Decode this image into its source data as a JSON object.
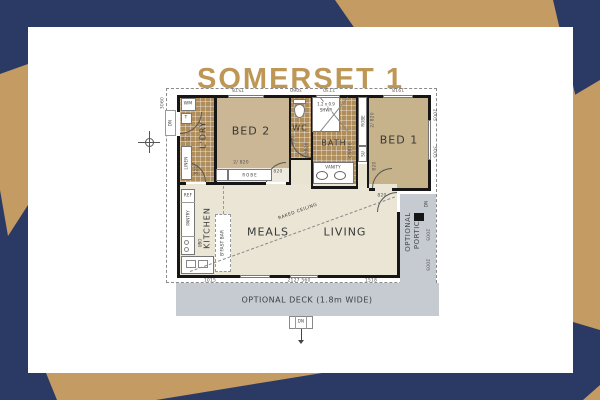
{
  "title": "SOMERSET 1",
  "colors": {
    "background_navy": "#2B3A64",
    "accent_gold": "#C39B63",
    "title_gold": "#BE9757",
    "wet_area_tile_tan": "#B08E5C",
    "bedroom_tan": "#CBB795",
    "floor_cream": "#EAE5D4",
    "deck_gray": "#C6CAD1"
  },
  "plan": {
    "rooms": {
      "ldry": "L'DRY",
      "bed2": "BED 2",
      "wc": "WC",
      "bath": "BATH",
      "bed1": "BED 1",
      "kitchen": "KITCHEN",
      "meals": "MEALS",
      "living": "LIVING",
      "portico_word1": "OPTIONAL",
      "portico_word2": "PORTICO",
      "deck": "OPTIONAL DECK (1.8m WIDE)"
    },
    "fixtures": {
      "wm": "WM",
      "tub": "T",
      "linen": "LINEN",
      "ref": "REF",
      "pantry": "PANTRY",
      "ubo": "UBO",
      "robe": "ROBE",
      "su": "SU",
      "vanity": "VANITY",
      "shower_size": "1.2 x 0.9",
      "shower": "SHWR",
      "bfast_bar": "B'FAST BAR",
      "raked_ceiling": "RAKED CEILING",
      "dn": "DN"
    },
    "doors": {
      "d820": "820",
      "d2x820": "2/ 820",
      "cavity": "CS820"
    },
    "dims": {
      "top": [
        "7578",
        "3060",
        "2730",
        "1918"
      ],
      "bottom": [
        "1015",
        "2127 560",
        "1518"
      ],
      "right": [
        "2005",
        "3005",
        "2005",
        "2005"
      ],
      "left": [
        "3060"
      ]
    }
  }
}
